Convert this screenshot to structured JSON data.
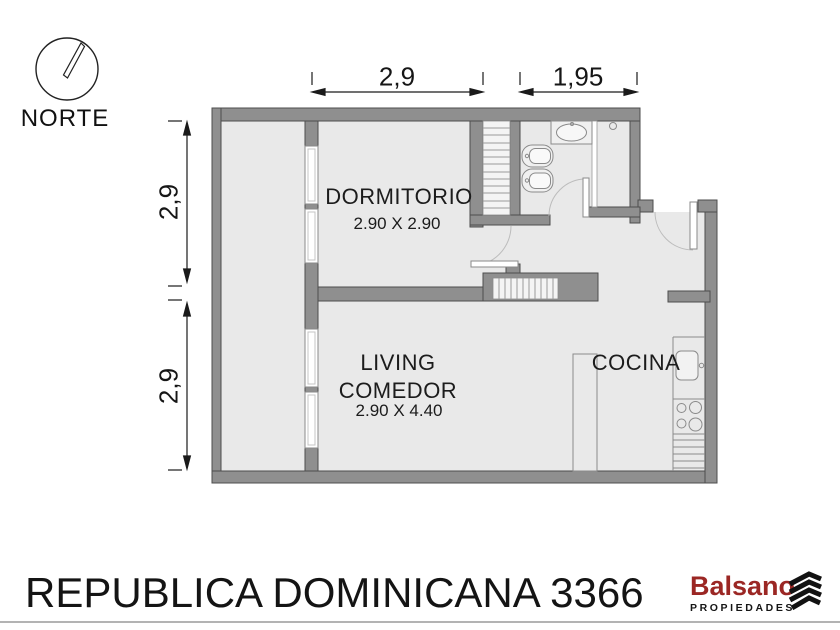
{
  "compass": {
    "label": "NORTE",
    "icon": "compass-north-icon"
  },
  "dimensions": {
    "top": [
      {
        "label": "2,9"
      },
      {
        "label": "1,95"
      }
    ],
    "left": [
      {
        "label": "2,9"
      },
      {
        "label": "2,9"
      }
    ]
  },
  "rooms": {
    "dormitorio": {
      "name": "DORMITORIO",
      "size": "2.90 X 2.90"
    },
    "living": {
      "line1": "LIVING",
      "line2": "COMEDOR",
      "size": "2.90 X 4.40"
    },
    "cocina": {
      "name": "COCINA"
    }
  },
  "footer": {
    "address": "REPUBLICA DOMINICANA 3366"
  },
  "logo": {
    "brand": "Balsano",
    "tagline": "PROPIEDADES",
    "icon": "stacked-chevrons-icon",
    "brand_color": "#9b2724"
  },
  "colors": {
    "wall_fill": "#8f8f8f",
    "wall_outline": "#4d4d4d",
    "floor": "#e9e9e9",
    "fixture_stroke": "#8a8a8a",
    "dimension": "#1a1a1a"
  }
}
